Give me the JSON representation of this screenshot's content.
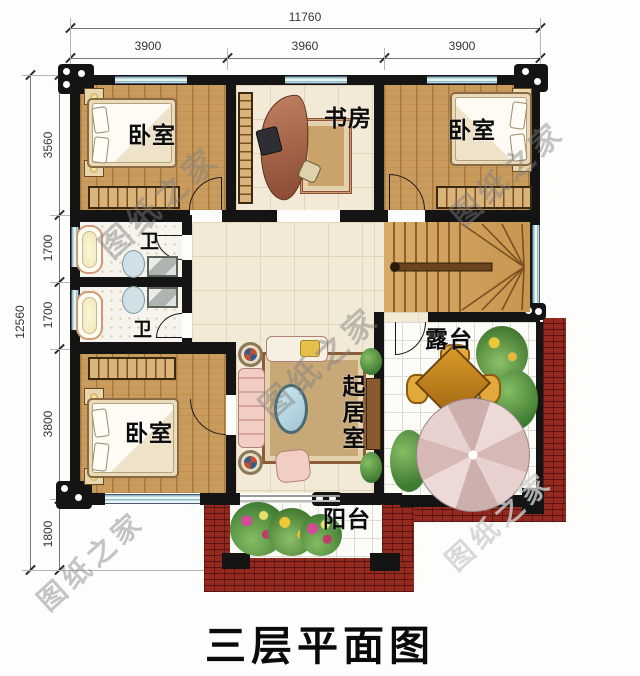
{
  "page": {
    "title": "三层平面图"
  },
  "watermark": {
    "text": "图纸之家"
  },
  "dimensions": {
    "top_total": "11760",
    "top_segments": [
      "3900",
      "3960",
      "3900"
    ],
    "left_total": "12560",
    "left_segments": [
      "3560",
      "1700",
      "1700",
      "3800",
      "1800"
    ]
  },
  "rooms": {
    "bedroom_top_left": "卧室",
    "study": "书房",
    "bedroom_top_right": "卧室",
    "bath_upper": "卫",
    "bath_lower": "卫",
    "terrace": "露台",
    "living_room": "起居室",
    "bedroom_bottom_left": "卧室",
    "balcony": "阳台"
  },
  "colors": {
    "wall": "#141414",
    "brick_red": "#93291f",
    "wood_floor": "#c99c5e",
    "tile_cream": "#f2e9d6",
    "window_teal": "#a9cfcf",
    "umbrella_pink": "#e5cfcd",
    "foliage_green": "#4e8a3a"
  }
}
